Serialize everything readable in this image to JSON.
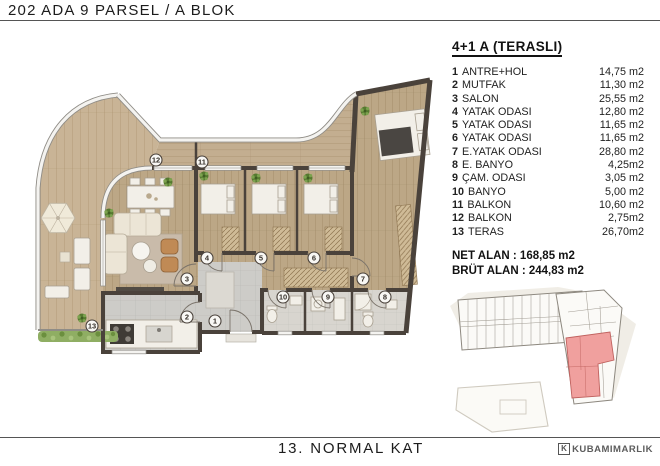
{
  "header": {
    "title": "202 ADA 9 PARSEL / A BLOK"
  },
  "legend": {
    "title": "4+1 A (TERASLI)",
    "rooms": [
      {
        "num": "1",
        "name": "ANTRE+HOL",
        "area": "14,75 m2"
      },
      {
        "num": "2",
        "name": "MUTFAK",
        "area": "11,30 m2"
      },
      {
        "num": "3",
        "name": "SALON",
        "area": "25,55 m2"
      },
      {
        "num": "4",
        "name": "YATAK ODASI",
        "area": "12,80 m2"
      },
      {
        "num": "5",
        "name": "YATAK ODASI",
        "area": "11,65 m2"
      },
      {
        "num": "6",
        "name": "YATAK ODASI",
        "area": "11,65 m2"
      },
      {
        "num": "7",
        "name": "E.YATAK ODASI",
        "area": "28,80 m2"
      },
      {
        "num": "8",
        "name": "E. BANYO",
        "area": "4,25m2"
      },
      {
        "num": "9",
        "name": "ÇAM. ODASI",
        "area": "3,05 m2"
      },
      {
        "num": "10",
        "name": "BANYO",
        "area": "5,00 m2"
      },
      {
        "num": "11",
        "name": "BALKON",
        "area": "10,60 m2"
      },
      {
        "num": "12",
        "name": "BALKON",
        "area": "2,75m2"
      },
      {
        "num": "13",
        "name": "TERAS",
        "area": "26,70m2"
      }
    ],
    "net": "NET ALAN : 168,85 m2",
    "brut": "BRÜT ALAN : 244,83 m2"
  },
  "footer": {
    "floor_label": "13. NORMAL KAT",
    "brand": "KUBAMIMARLIK"
  },
  "floor_plan": {
    "room_markers": [
      {
        "num": "1",
        "x": 215,
        "y": 321
      },
      {
        "num": "2",
        "x": 187,
        "y": 317
      },
      {
        "num": "3",
        "x": 187,
        "y": 279
      },
      {
        "num": "4",
        "x": 207,
        "y": 258
      },
      {
        "num": "5",
        "x": 261,
        "y": 258
      },
      {
        "num": "6",
        "x": 314,
        "y": 258
      },
      {
        "num": "7",
        "x": 363,
        "y": 279
      },
      {
        "num": "8",
        "x": 385,
        "y": 297
      },
      {
        "num": "9",
        "x": 328,
        "y": 297
      },
      {
        "num": "10",
        "x": 283,
        "y": 297
      },
      {
        "num": "11",
        "x": 202,
        "y": 162
      },
      {
        "num": "12",
        "x": 156,
        "y": 160
      },
      {
        "num": "13",
        "x": 92,
        "y": 326
      }
    ]
  },
  "colors": {
    "wall": "#4a423b",
    "wood": "#bca786",
    "wood_light": "#c9b496",
    "wood_balcony": "#c3ae90",
    "tile": "#cdccc8",
    "bath_tile": "#d8d5cf",
    "highlight": "#f0a09e",
    "plant": "#55792f"
  }
}
